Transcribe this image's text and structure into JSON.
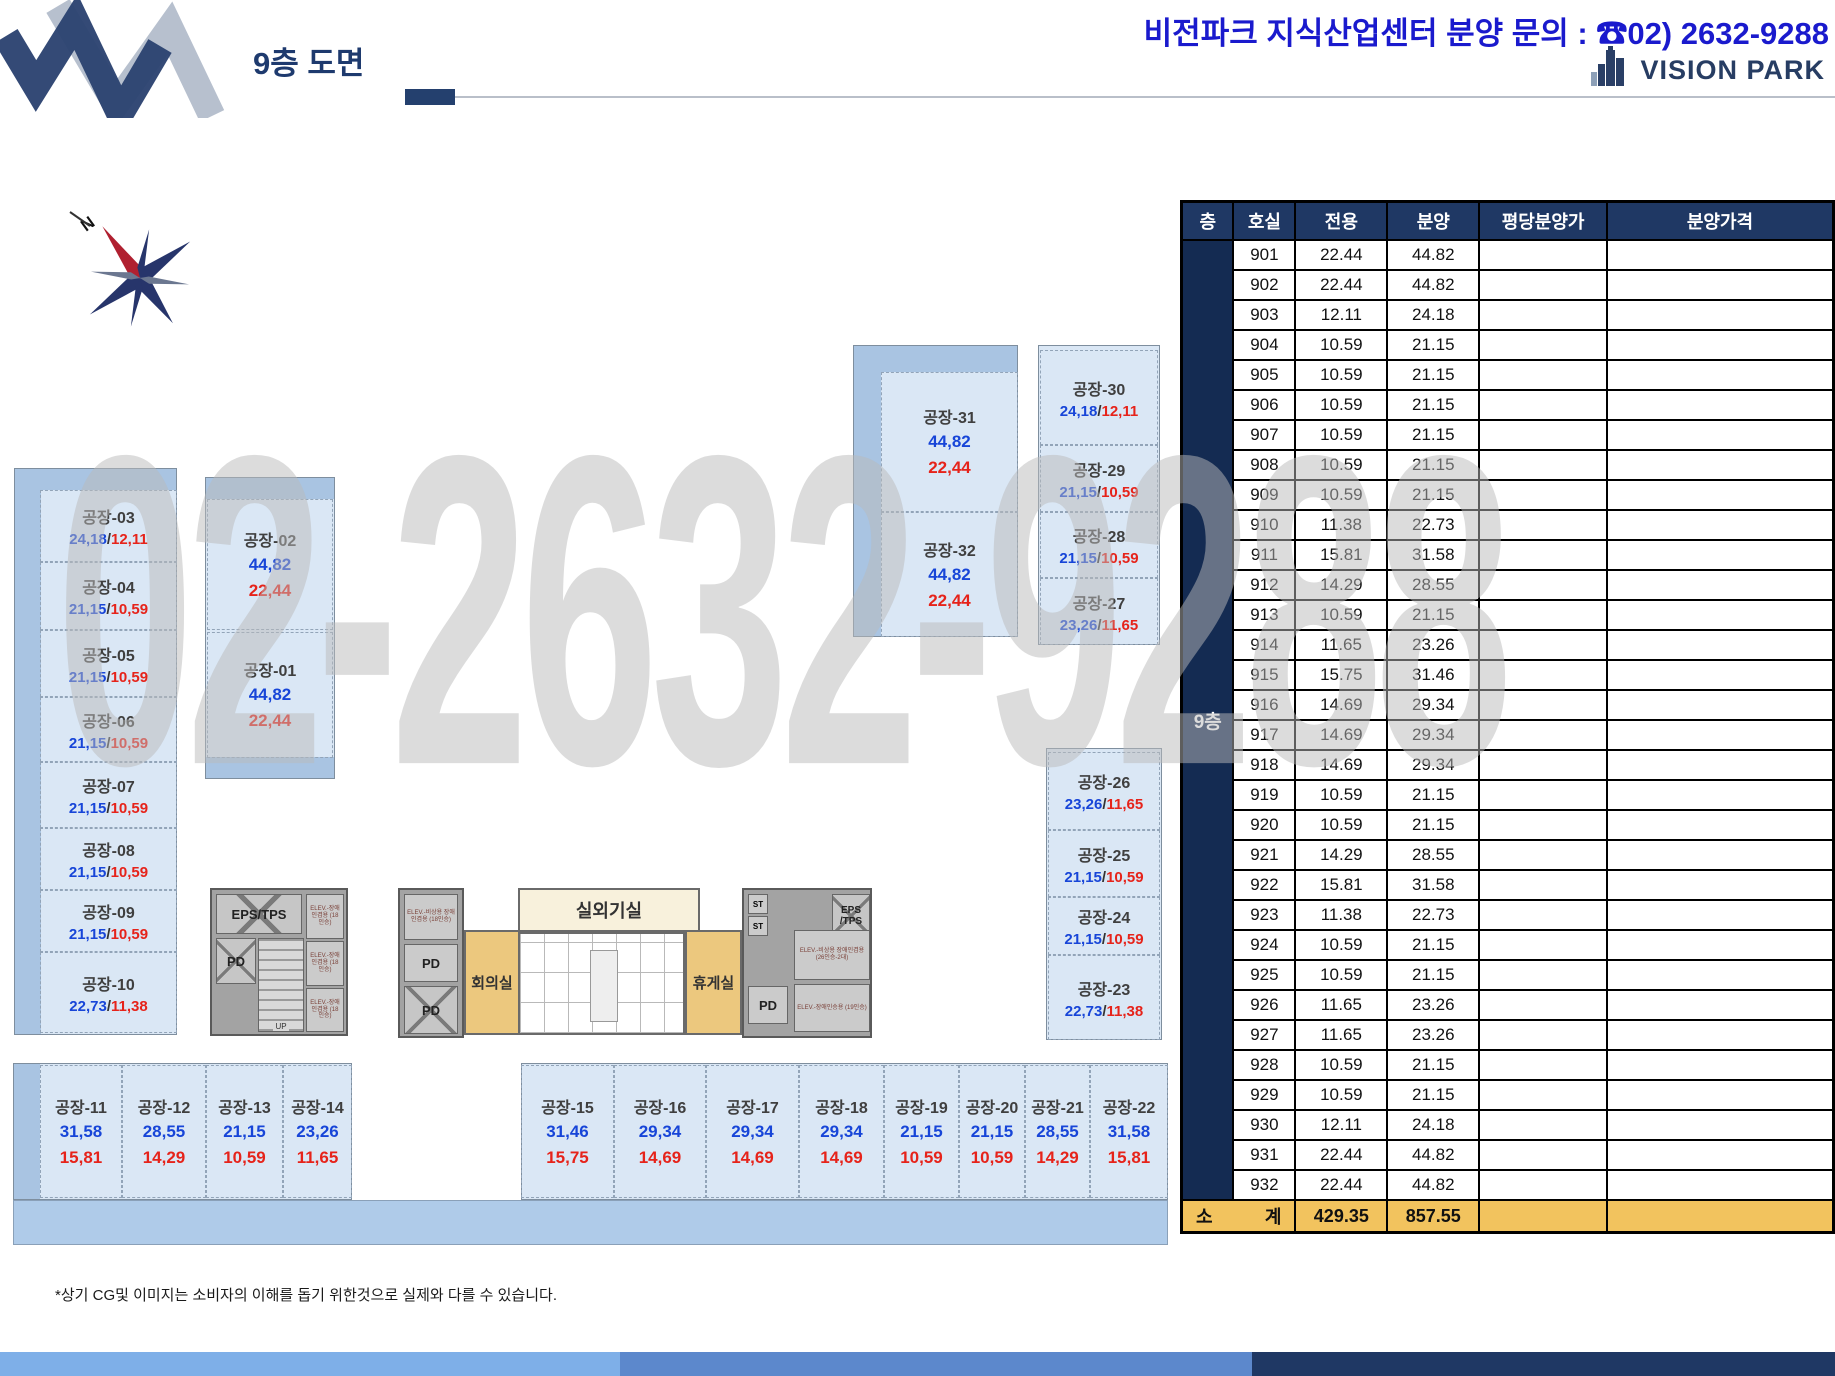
{
  "header": {
    "title": "9층 도면",
    "contact": "비전파크 지식산업센터 분양 문의 : ☎02) 2632-9288",
    "brand": "VISION PARK"
  },
  "compass": {
    "north_label": "N"
  },
  "watermark": "02-2632-9288",
  "plan": {
    "value_separator": "/",
    "rooms": [
      {
        "name": "공장-01",
        "a": "44,82",
        "b": "22,44"
      },
      {
        "name": "공장-02",
        "a": "44,82",
        "b": "22,44"
      },
      {
        "name": "공장-03",
        "a": "24,18",
        "b": "12,11"
      },
      {
        "name": "공장-04",
        "a": "21,15",
        "b": "10,59"
      },
      {
        "name": "공장-05",
        "a": "21,15",
        "b": "10,59"
      },
      {
        "name": "공장-06",
        "a": "21,15",
        "b": "10,59"
      },
      {
        "name": "공장-07",
        "a": "21,15",
        "b": "10,59"
      },
      {
        "name": "공장-08",
        "a": "21,15",
        "b": "10,59"
      },
      {
        "name": "공장-09",
        "a": "21,15",
        "b": "10,59"
      },
      {
        "name": "공장-10",
        "a": "22,73",
        "b": "11,38"
      },
      {
        "name": "공장-11",
        "a": "31,58",
        "b": "15,81"
      },
      {
        "name": "공장-12",
        "a": "28,55",
        "b": "14,29"
      },
      {
        "name": "공장-13",
        "a": "21,15",
        "b": "10,59"
      },
      {
        "name": "공장-14",
        "a": "23,26",
        "b": "11,65"
      },
      {
        "name": "공장-15",
        "a": "31,46",
        "b": "15,75"
      },
      {
        "name": "공장-16",
        "a": "29,34",
        "b": "14,69"
      },
      {
        "name": "공장-17",
        "a": "29,34",
        "b": "14,69"
      },
      {
        "name": "공장-18",
        "a": "29,34",
        "b": "14,69"
      },
      {
        "name": "공장-19",
        "a": "21,15",
        "b": "10,59"
      },
      {
        "name": "공장-20",
        "a": "21,15",
        "b": "10,59"
      },
      {
        "name": "공장-21",
        "a": "28,55",
        "b": "14,29"
      },
      {
        "name": "공장-22",
        "a": "31,58",
        "b": "15,81"
      },
      {
        "name": "공장-23",
        "a": "22,73",
        "b": "11,38"
      },
      {
        "name": "공장-24",
        "a": "21,15",
        "b": "10,59"
      },
      {
        "name": "공장-25",
        "a": "21,15",
        "b": "10,59"
      },
      {
        "name": "공장-26",
        "a": "23,26",
        "b": "11,65"
      },
      {
        "name": "공장-27",
        "a": "23,26",
        "b": "11,65"
      },
      {
        "name": "공장-28",
        "a": "21,15",
        "b": "10,59"
      },
      {
        "name": "공장-29",
        "a": "21,15",
        "b": "10,59"
      },
      {
        "name": "공장-30",
        "a": "24,18",
        "b": "12,11"
      },
      {
        "name": "공장-31",
        "a": "44,82",
        "b": "22,44"
      },
      {
        "name": "공장-32",
        "a": "44,82",
        "b": "22,44"
      }
    ],
    "facilities": {
      "outdoor_unit": "실외기실",
      "meeting_room": "회의실",
      "lounge": "휴게실",
      "eps_tps": "EPS/TPS",
      "eps_tps_split": "EPS /TPS",
      "pd": "PD",
      "up": "UP",
      "st": "ST",
      "elev_a": "ELEV.-비상용 장애인겸용 (18인승)",
      "elev_b": "ELEV.-장애인겸용 (18인승)",
      "elev_c": "ELEV.-비상용 장애인겸용 (26인승-2대)",
      "elev_d": "ELEV.-장애인승용 (19인승)"
    }
  },
  "table": {
    "columns": [
      "층",
      "호실",
      "전용",
      "분양",
      "평당분양가",
      "분양가격"
    ],
    "floor_label": "9층",
    "rows": [
      {
        "room": "901",
        "exclusive": "22.44",
        "supply": "44.82"
      },
      {
        "room": "902",
        "exclusive": "22.44",
        "supply": "44.82"
      },
      {
        "room": "903",
        "exclusive": "12.11",
        "supply": "24.18"
      },
      {
        "room": "904",
        "exclusive": "10.59",
        "supply": "21.15"
      },
      {
        "room": "905",
        "exclusive": "10.59",
        "supply": "21.15"
      },
      {
        "room": "906",
        "exclusive": "10.59",
        "supply": "21.15"
      },
      {
        "room": "907",
        "exclusive": "10.59",
        "supply": "21.15"
      },
      {
        "room": "908",
        "exclusive": "10.59",
        "supply": "21.15"
      },
      {
        "room": "909",
        "exclusive": "10.59",
        "supply": "21.15"
      },
      {
        "room": "910",
        "exclusive": "11.38",
        "supply": "22.73"
      },
      {
        "room": "911",
        "exclusive": "15.81",
        "supply": "31.58"
      },
      {
        "room": "912",
        "exclusive": "14.29",
        "supply": "28.55"
      },
      {
        "room": "913",
        "exclusive": "10.59",
        "supply": "21.15"
      },
      {
        "room": "914",
        "exclusive": "11.65",
        "supply": "23.26"
      },
      {
        "room": "915",
        "exclusive": "15.75",
        "supply": "31.46"
      },
      {
        "room": "916",
        "exclusive": "14.69",
        "supply": "29.34"
      },
      {
        "room": "917",
        "exclusive": "14.69",
        "supply": "29.34"
      },
      {
        "room": "918",
        "exclusive": "14.69",
        "supply": "29.34"
      },
      {
        "room": "919",
        "exclusive": "10.59",
        "supply": "21.15"
      },
      {
        "room": "920",
        "exclusive": "10.59",
        "supply": "21.15"
      },
      {
        "room": "921",
        "exclusive": "14.29",
        "supply": "28.55"
      },
      {
        "room": "922",
        "exclusive": "15.81",
        "supply": "31.58"
      },
      {
        "room": "923",
        "exclusive": "11.38",
        "supply": "22.73"
      },
      {
        "room": "924",
        "exclusive": "10.59",
        "supply": "21.15"
      },
      {
        "room": "925",
        "exclusive": "10.59",
        "supply": "21.15"
      },
      {
        "room": "926",
        "exclusive": "11.65",
        "supply": "23.26"
      },
      {
        "room": "927",
        "exclusive": "11.65",
        "supply": "23.26"
      },
      {
        "room": "928",
        "exclusive": "10.59",
        "supply": "21.15"
      },
      {
        "room": "929",
        "exclusive": "10.59",
        "supply": "21.15"
      },
      {
        "room": "930",
        "exclusive": "12.11",
        "supply": "24.18"
      },
      {
        "room": "931",
        "exclusive": "22.44",
        "supply": "44.82"
      },
      {
        "room": "932",
        "exclusive": "22.44",
        "supply": "44.82"
      }
    ],
    "total": {
      "label_left": "소",
      "label_right": "계",
      "exclusive": "429.35",
      "supply": "857.55"
    }
  },
  "footer": {
    "note": "*상기 CG및 이미지는 소비자의 이해를 돕기 위한것으로 실제와 다를 수 있습니다."
  }
}
